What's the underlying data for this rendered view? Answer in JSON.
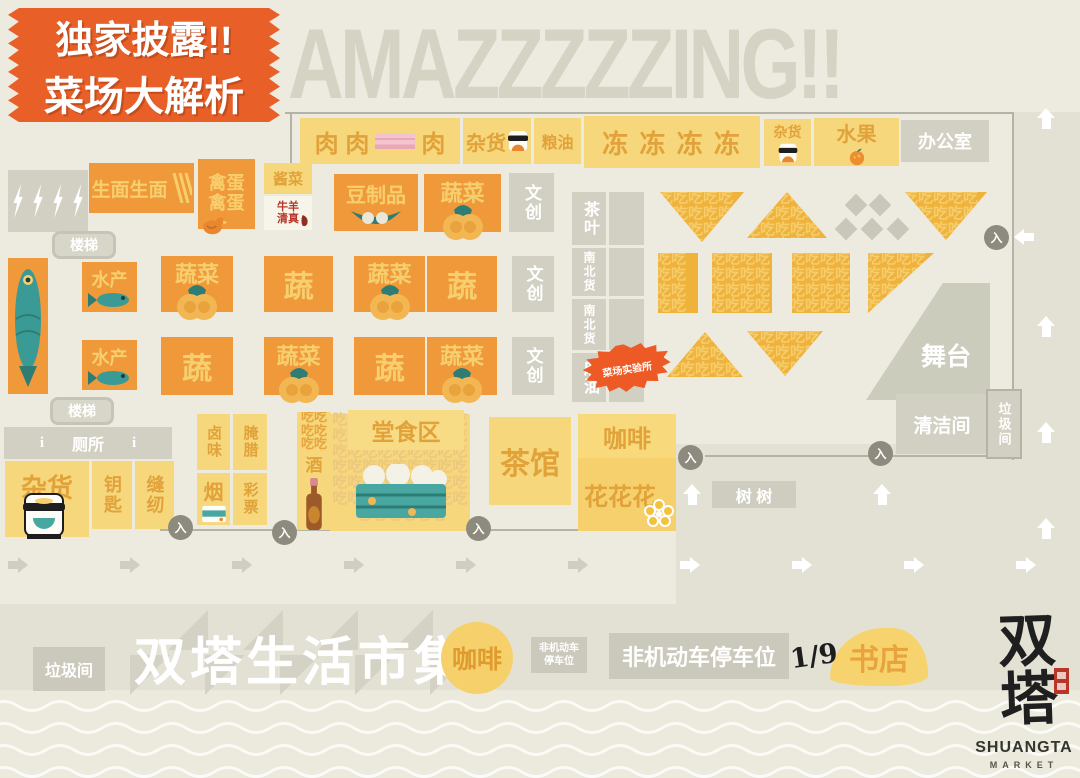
{
  "badge": {
    "line1": "独家披露!!",
    "line2": "菜场大解析"
  },
  "banner": {
    "text": "AMAZZZZZING!!"
  },
  "labels": {
    "meat_a": "肉 肉",
    "meat_b": "肉",
    "groceries": "杂货",
    "grain": "粮油",
    "frozen": "冻 冻 冻 冻",
    "fruit": "水果",
    "office": "办公室",
    "raw_noodles": "生面生面",
    "poultry": "禽蛋",
    "pickles": "酱菜",
    "halal_a": "牛羊",
    "halal_b": "清真",
    "tofu": "豆制品",
    "vegetables": "蔬菜",
    "veg_short": "蔬",
    "cultural": "文创",
    "stairs": "楼梯",
    "aquatic": "水产",
    "tea": "茶叶",
    "north_south": "南北货",
    "sesame_oil": "麻油",
    "lab": "菜场实验所",
    "stage": "舞台",
    "cleaning": "清洁间",
    "garbage": "垃圾间",
    "toilet": "厕所",
    "keys": "钥匙",
    "sewing": "缝纫",
    "braised": "卤味",
    "cured": "腌腊",
    "tobacco": "烟",
    "lottery": "彩票",
    "wine": "酒",
    "dining": "堂食区",
    "teahouse": "茶馆",
    "coffee": "咖啡",
    "flowers": "花花花",
    "trees": "树 树",
    "entrance": "入",
    "market_title": "双塔生活市集",
    "parking_a": "非机动车",
    "parking_b": "停车位",
    "parking_full": "非机动车停车位",
    "fraction": "1/9",
    "bookstore": "书店",
    "eat": "吃"
  },
  "logo": {
    "cn": "双塔",
    "en": "SHUANGTA",
    "sub": "MARKET"
  },
  "icons": {
    "lightning": "⚡",
    "diamond": "◆",
    "up_arrow": "⬆",
    "right_arrow": "➡",
    "left_arrow": "⬅",
    "info": "i"
  },
  "colors": {
    "background": "#edebe0",
    "stall_yellow": "#f6d77c",
    "stall_orange": "#f0993a",
    "gray_block": "#d2d0c2",
    "badge_orange": "#e85f28",
    "eat_orange": "#efb23a",
    "accent_text": "#e2a23a",
    "teal": "#3a9a96",
    "seal_red": "#b8352a"
  }
}
